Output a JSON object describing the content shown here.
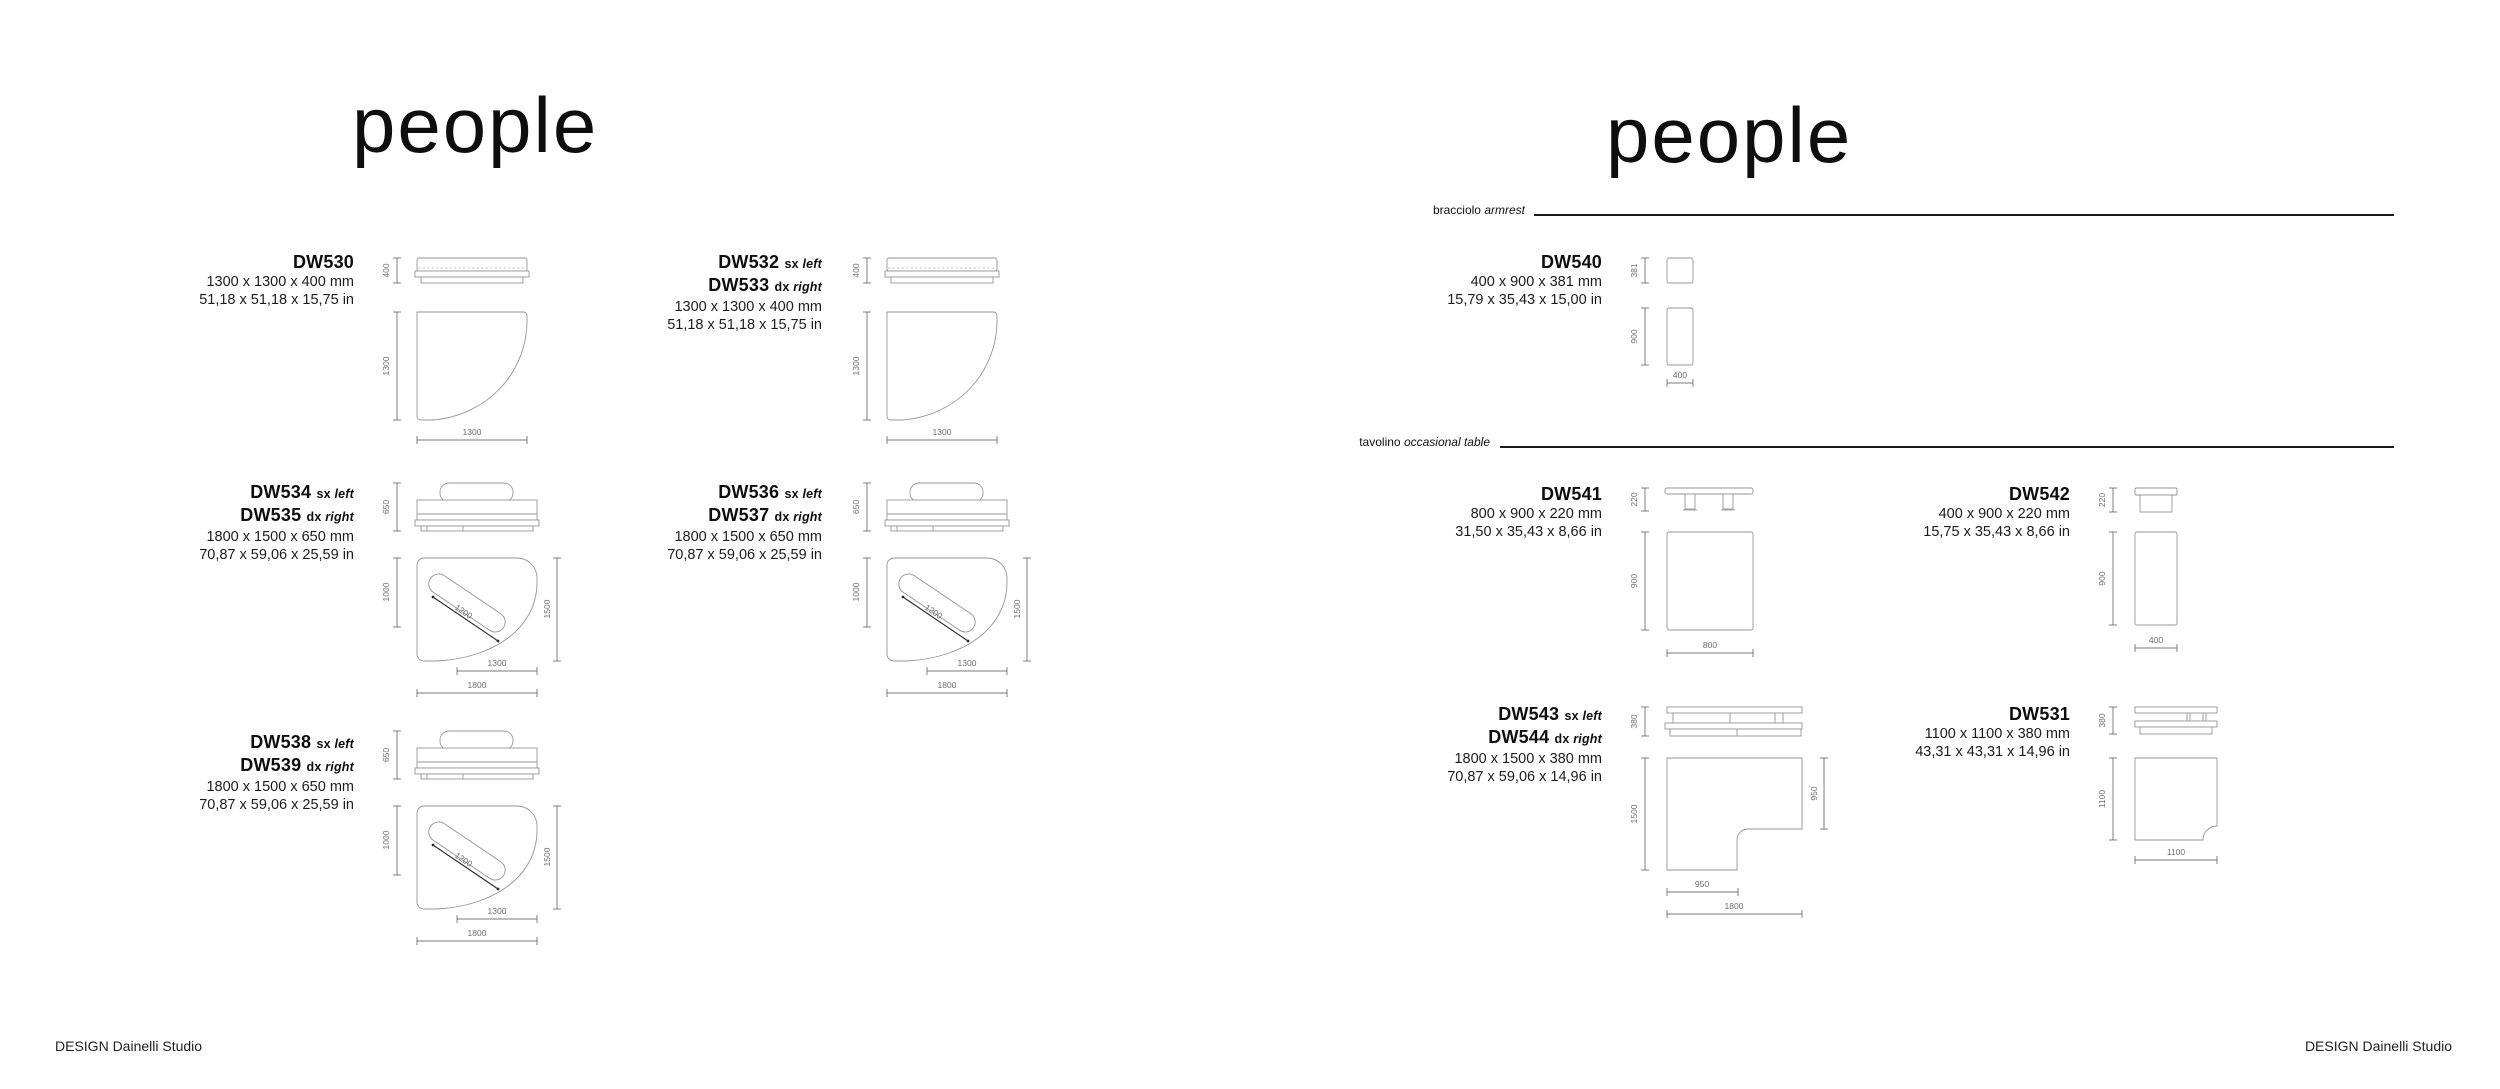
{
  "left": {
    "title": "people",
    "footer": "DESIGN Dainelli Studio",
    "blocks": {
      "dw530": {
        "c1": "DW530",
        "mm": "1300 x 1300 x 400 mm",
        "inch": "51,18 x 51,18 x 15,75 in",
        "dh": "400",
        "ds": "1300",
        "dw": "1300"
      },
      "dw532": {
        "c1": "DW532",
        "v1a": "sx",
        "v1b": "left",
        "c2": "DW533",
        "v2a": "dx",
        "v2b": "right",
        "mm": "1300 x 1300 x 400 mm",
        "inch": "51,18 x 51,18 x 15,75 in",
        "dh": "400",
        "ds": "1300",
        "dw": "1300"
      },
      "dw534": {
        "c1": "DW534",
        "v1a": "sx",
        "v1b": "left",
        "c2": "DW535",
        "v2a": "dx",
        "v2b": "right",
        "mm": "1800 x 1500 x 650 mm",
        "inch": "70,87 x 59,06 x 25,59 in",
        "dh": "650",
        "dl": "1000",
        "dr": "1500",
        "ddg": "1200",
        "db1": "1300",
        "db2": "1800"
      },
      "dw536": {
        "c1": "DW536",
        "v1a": "sx",
        "v1b": "left",
        "c2": "DW537",
        "v2a": "dx",
        "v2b": "right",
        "mm": "1800 x 1500 x 650 mm",
        "inch": "70,87 x 59,06 x 25,59 in",
        "dh": "650",
        "dl": "1000",
        "dr": "1500",
        "ddg": "1200",
        "db1": "1300",
        "db2": "1800"
      },
      "dw538": {
        "c1": "DW538",
        "v1a": "sx",
        "v1b": "left",
        "c2": "DW539",
        "v2a": "dx",
        "v2b": "right",
        "mm": "1800 x 1500 x 650 mm",
        "inch": "70,87 x 59,06 x 25,59 in",
        "dh": "650",
        "dl": "1000",
        "dr": "1500",
        "ddg": "1200",
        "db1": "1300",
        "db2": "1800"
      }
    }
  },
  "right": {
    "title": "people",
    "footer": "DESIGN Dainelli Studio",
    "sections": {
      "armrest": {
        "it": "bracciolo",
        "en": "armrest"
      },
      "table": {
        "it": "tavolino",
        "en": "occasional table"
      }
    },
    "blocks": {
      "dw540": {
        "c1": "DW540",
        "mm": "400 x 900 x 381 mm",
        "inch": "15,79 x 35,43 x 15,00 in",
        "dh": "381",
        "ds": "900",
        "dw": "400"
      },
      "dw541": {
        "c1": "DW541",
        "mm": "800 x 900 x 220 mm",
        "inch": "31,50 x 35,43 x 8,66 in",
        "dh": "220",
        "ds": "900",
        "dw": "800"
      },
      "dw542": {
        "c1": "DW542",
        "mm": "400 x 900 x 220 mm",
        "inch": "15,75 x 35,43 x 8,66 in",
        "dh": "220",
        "ds": "900",
        "dw": "400"
      },
      "dw543": {
        "c1": "DW543",
        "v1a": "sx",
        "v1b": "left",
        "c2": "DW544",
        "v2a": "dx",
        "v2b": "right",
        "mm": "1800 x 1500 x 380 mm",
        "inch": "70,87 x 59,06 x 14,96 in",
        "dh": "380",
        "dl": "1500",
        "dr": "950",
        "db1": "950",
        "db2": "1800"
      },
      "dw531": {
        "c1": "DW531",
        "mm": "1100 x 1100 x 380 mm",
        "inch": "43,31 x 43,31 x 14,96 in",
        "dh": "380",
        "ds": "1100",
        "dw": "1100"
      }
    }
  }
}
